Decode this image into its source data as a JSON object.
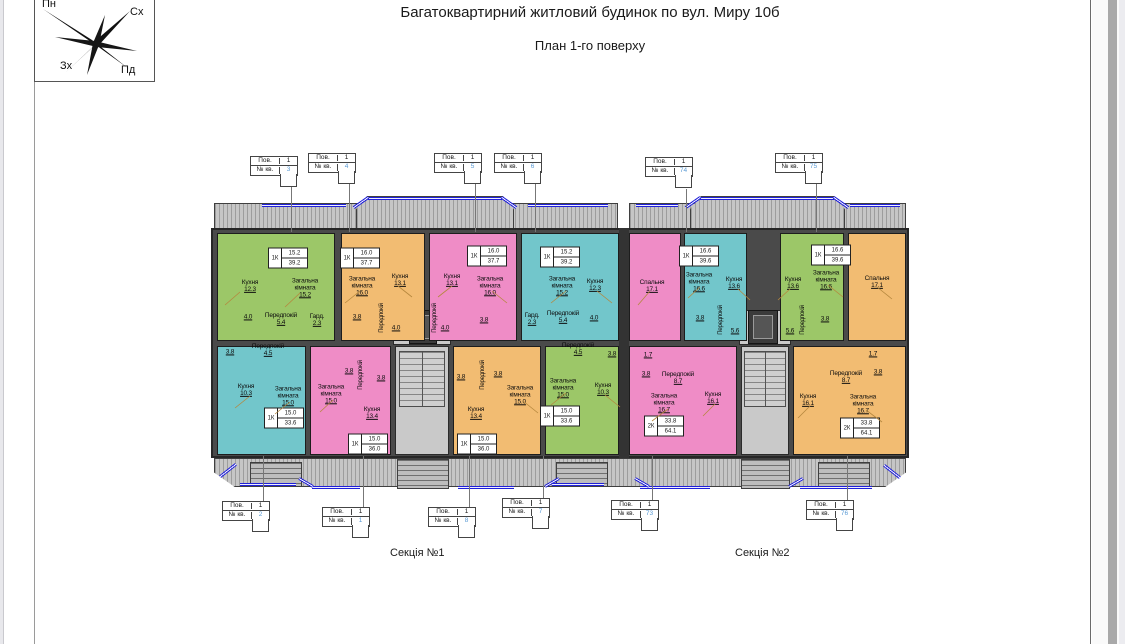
{
  "page": {
    "title": "Багатоквартирний житловий будинок по вул. Миру 10б",
    "subtitle": "План 1-го поверху"
  },
  "compass": {
    "north": "Пн",
    "east": "Сх",
    "west": "Зх",
    "south": "Пд"
  },
  "sections": [
    {
      "label": "Секція №1"
    },
    {
      "label": "Секція №2"
    }
  ],
  "kv_label": {
    "floor": "Пов.",
    "one": "1",
    "apt": "№ кв."
  },
  "kv_tags": [
    {
      "num": "3"
    },
    {
      "num": "4"
    },
    {
      "num": "5"
    },
    {
      "num": "6"
    },
    {
      "num": "74"
    },
    {
      "num": "75"
    },
    {
      "num": "2"
    },
    {
      "num": "1"
    },
    {
      "num": "8"
    },
    {
      "num": "7"
    },
    {
      "num": "73"
    },
    {
      "num": "76"
    }
  ],
  "apartments": [
    {
      "kv": "3",
      "color": "green",
      "type": "1К",
      "living": "15.2",
      "total": "39.2",
      "rooms": [
        {
          "n": "Кухня",
          "a": "12.3"
        },
        {
          "n": "Загальна\nкімната",
          "a": "15.2"
        },
        {
          "n": "Передпокій",
          "a": "5.4"
        },
        {
          "n": "Гард.",
          "a": "2.3"
        },
        {
          "n": "",
          "a": "4.0"
        }
      ]
    },
    {
      "kv": "4",
      "color": "orange",
      "type": "1К",
      "living": "16.0",
      "total": "37.7",
      "rooms": [
        {
          "n": "Загальна\nкімната",
          "a": "16.0"
        },
        {
          "n": "Кухня",
          "a": "13.1"
        },
        {
          "n": "",
          "a": "3.8"
        },
        {
          "n": "",
          "a": "4.0"
        },
        {
          "n": "Передпокій",
          "a": ""
        }
      ]
    },
    {
      "kv": "5",
      "color": "pink",
      "type": "1К",
      "living": "16.0",
      "total": "37.7",
      "rooms": [
        {
          "n": "Кухня",
          "a": "13.1"
        },
        {
          "n": "Загальна\nкімната",
          "a": "16.0"
        },
        {
          "n": "",
          "a": "3.8"
        },
        {
          "n": "",
          "a": "4.0"
        },
        {
          "n": "Передпокій",
          "a": ""
        }
      ]
    },
    {
      "kv": "6",
      "color": "cyan",
      "type": "1К",
      "living": "15.2",
      "total": "39.2",
      "rooms": [
        {
          "n": "Загальна\nкімната",
          "a": "15.2"
        },
        {
          "n": "Кухня",
          "a": "12.3"
        },
        {
          "n": "Передпокій",
          "a": "5.4"
        },
        {
          "n": "Гард.",
          "a": "2.3"
        },
        {
          "n": "",
          "a": "4.0"
        }
      ]
    },
    {
      "kv": "2",
      "color": "cyan",
      "type": "1К",
      "living": "15.0",
      "total": "33.6",
      "rooms": [
        {
          "n": "Кухня",
          "a": "10.3"
        },
        {
          "n": "Загальна\nкімната",
          "a": "15.0"
        },
        {
          "n": "Передпокій",
          "a": "4.5"
        },
        {
          "n": "",
          "a": "3.8"
        }
      ]
    },
    {
      "kv": "1",
      "color": "pink",
      "type": "1К",
      "living": "15.0",
      "total": "36.0",
      "rooms": [
        {
          "n": "Загальна\nкімната",
          "a": "15.0"
        },
        {
          "n": "Кухня",
          "a": "13.4"
        },
        {
          "n": "",
          "a": "3.8"
        },
        {
          "n": "",
          "a": "3.8"
        },
        {
          "n": "Передпокій",
          "a": ""
        }
      ]
    },
    {
      "kv": "8",
      "color": "orange",
      "type": "1К",
      "living": "15.0",
      "total": "36.0",
      "rooms": [
        {
          "n": "Кухня",
          "a": "13.4"
        },
        {
          "n": "Загальна\nкімната",
          "a": "15.0"
        },
        {
          "n": "",
          "a": "3.8"
        },
        {
          "n": "",
          "a": "3.8"
        },
        {
          "n": "Передпокій",
          "a": ""
        }
      ]
    },
    {
      "kv": "7",
      "color": "green",
      "type": "1К",
      "living": "15.0",
      "total": "33.6",
      "rooms": [
        {
          "n": "Загальна\nкімната",
          "a": "15.0"
        },
        {
          "n": "Кухня",
          "a": "10.3"
        },
        {
          "n": "Передпокій",
          "a": "4.5"
        },
        {
          "n": "",
          "a": "3.8"
        }
      ]
    },
    {
      "kv": "73",
      "color": "pink",
      "type": "2К",
      "living": "33.8",
      "total": "64.1",
      "rooms": [
        {
          "n": "Спальня",
          "a": "17.1"
        },
        {
          "n": "Загальна\nкімната",
          "a": "16.7"
        },
        {
          "n": "Кухня",
          "a": "16.1"
        },
        {
          "n": "Передпокій",
          "a": "8.7"
        },
        {
          "n": "",
          "a": "3.8"
        },
        {
          "n": "",
          "a": "1.7"
        }
      ]
    },
    {
      "kv": "74",
      "color": "cyan",
      "type": "1К",
      "living": "16.6",
      "total": "39.6",
      "rooms": [
        {
          "n": "Загальна\nкімната",
          "a": "16.6"
        },
        {
          "n": "Кухня",
          "a": "13.6"
        },
        {
          "n": "Передпокій",
          "a": "5.6"
        },
        {
          "n": "",
          "a": "3.8"
        }
      ]
    },
    {
      "kv": "75",
      "color": "green",
      "type": "1К",
      "living": "16.6",
      "total": "39.6",
      "rooms": [
        {
          "n": "Кухня",
          "a": "13.6"
        },
        {
          "n": "Загальна\nкімната",
          "a": "16.6"
        },
        {
          "n": "Передпокій",
          "a": "5.6"
        },
        {
          "n": "",
          "a": "3.8"
        }
      ]
    },
    {
      "kv": "76",
      "color": "orange",
      "type": "2К",
      "living": "33.8",
      "total": "64.1",
      "rooms": [
        {
          "n": "Спальня",
          "a": "17.1"
        },
        {
          "n": "Кухня",
          "a": "16.1"
        },
        {
          "n": "Загальна\nкімната",
          "a": "16.7"
        },
        {
          "n": "Передпокій",
          "a": "8.7"
        },
        {
          "n": "",
          "a": "3.8"
        },
        {
          "n": "",
          "a": "1.7"
        }
      ]
    }
  ],
  "colors": {
    "green": "#9cc768",
    "orange": "#f2bc72",
    "pink": "#ef8cc6",
    "cyan": "#72c6cb",
    "wall": "#4a4a4a",
    "window_blue": "#2020d8",
    "apt_number_blue": "#5b9bd5"
  }
}
